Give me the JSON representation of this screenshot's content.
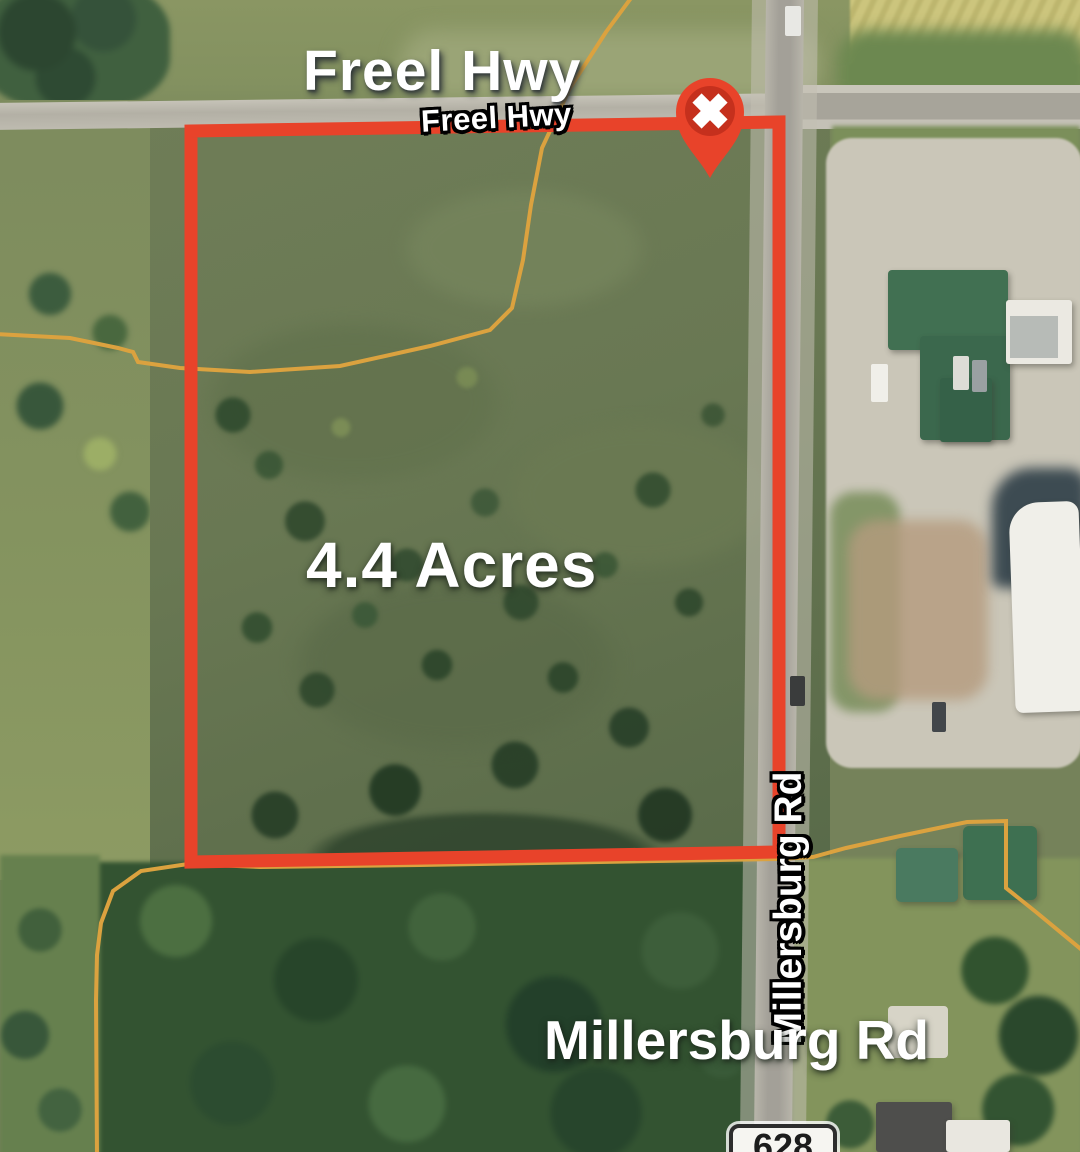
{
  "map": {
    "title": "Freel Hwy",
    "area_label": "4.4 Acres",
    "road_labels": {
      "freel_hwy_small": "Freel Hwy",
      "millersburg_vertical": "Millersburg Rd",
      "millersburg_large": "Millersburg Rd"
    },
    "route_shield": "628",
    "marker": {
      "icon": "x-pin-icon",
      "color": "#e8432a",
      "inner_color": "#c5301d",
      "glyph_color": "#ffffff"
    },
    "boundary": {
      "color": "#e8432a"
    },
    "parcel_lines": {
      "color": "#dba23f"
    }
  }
}
